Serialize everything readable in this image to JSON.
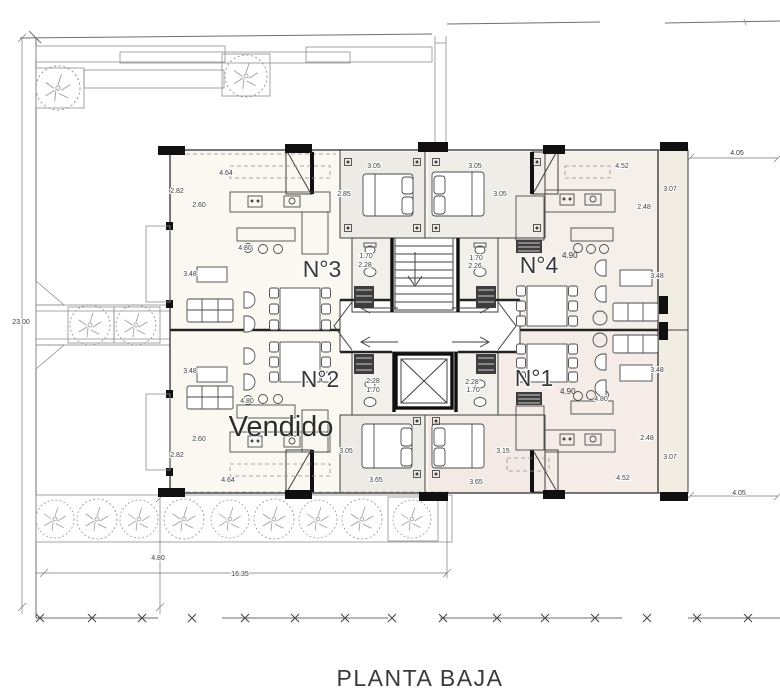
{
  "plan": {
    "title": "PLANTA BAJA"
  },
  "units": {
    "n3": {
      "label": "N°3"
    },
    "n4": {
      "label": "N°4",
      "height_note": "4.90"
    },
    "n2": {
      "label": "N°2",
      "status": "Vendido"
    },
    "n1": {
      "label": "N°1",
      "height_note": "4.90"
    }
  },
  "dims": {
    "d_464_top": "4.64",
    "d_282_top": "2.82",
    "d_260_top": "2.60",
    "d_348_left_top": "3.48",
    "d_480_island3": "4.80",
    "d_305_bed3_w": "3.05",
    "d_285_bed3_d": "2.85",
    "d_305_bed4_w": "3.05",
    "d_305_bed4_d": "3.05",
    "d_452_top": "4.52",
    "d_307_right_top": "3.07",
    "d_248_top": "2.48",
    "d_405_top": "4.05",
    "d_170_bath3": "1.70",
    "d_228_bath3": "2.28",
    "d_170_bath4": "1.70",
    "d_226_bath4": "2.26",
    "d_348_right_top": "3.48",
    "d_348_right_bot": "3.48",
    "d_348_left_bot": "3.48",
    "d_228_bath2": "2.28",
    "d_170_bath2": "1.70",
    "d_228_bath1": "2.28",
    "d_170_bath1": "1.70",
    "d_480_island2": "4.80",
    "d_480_island1": "4.80",
    "d_260_bot": "2.60",
    "d_282_bot": "2.82",
    "d_464_bot": "4.64",
    "d_305_bed2_d": "3.05",
    "d_365_bed2_w": "3.65",
    "d_365_bed1_w": "3.65",
    "d_315_bed1_d": "3.15",
    "d_452_bot": "4.52",
    "d_307_right_bot": "3.07",
    "d_248_bot": "2.48",
    "d_405_bot": "4.05",
    "d_2300_site": "23.00",
    "d_480_garden": "4.80",
    "d_1635_site": "16.35"
  }
}
